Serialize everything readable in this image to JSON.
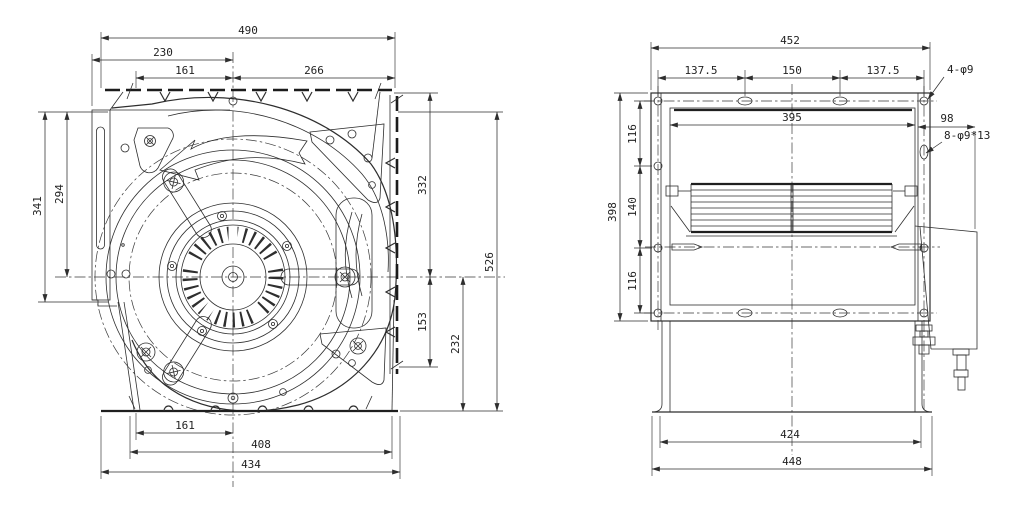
{
  "drawing": {
    "background": "#ffffff",
    "line_color": "#2e2e2e",
    "views": {
      "front": {
        "name": "fan-front-view",
        "dims": {
          "top_overall": "490",
          "top_left_to_center": "230",
          "top_hole_to_center": "161",
          "top_center_to_right": "266",
          "left_outer_height": "341",
          "left_top_to_center": "294",
          "right_flange_to_center": "332",
          "right_center_to_cutoff": "153",
          "right_center_to_base": "232",
          "right_overall_height": "526",
          "bottom_hole_to_center": "161",
          "bottom_bolt_span": "408",
          "bottom_overall": "434"
        }
      },
      "side": {
        "name": "fan-side-view",
        "dims": {
          "top_overall": "452",
          "top_pitch_left": "137.5",
          "top_pitch_mid": "150",
          "top_pitch_right": "137.5",
          "corner_holes_label": "4-φ9",
          "inner_width": "395",
          "motor_protrusion": "98",
          "side_slots_label": "8-φ9*13",
          "left_overall_height": "398",
          "left_pitch_top": "116",
          "left_pitch_mid": "140",
          "left_pitch_bottom": "116",
          "bottom_feet_span": "424",
          "bottom_overall": "448"
        }
      }
    }
  }
}
